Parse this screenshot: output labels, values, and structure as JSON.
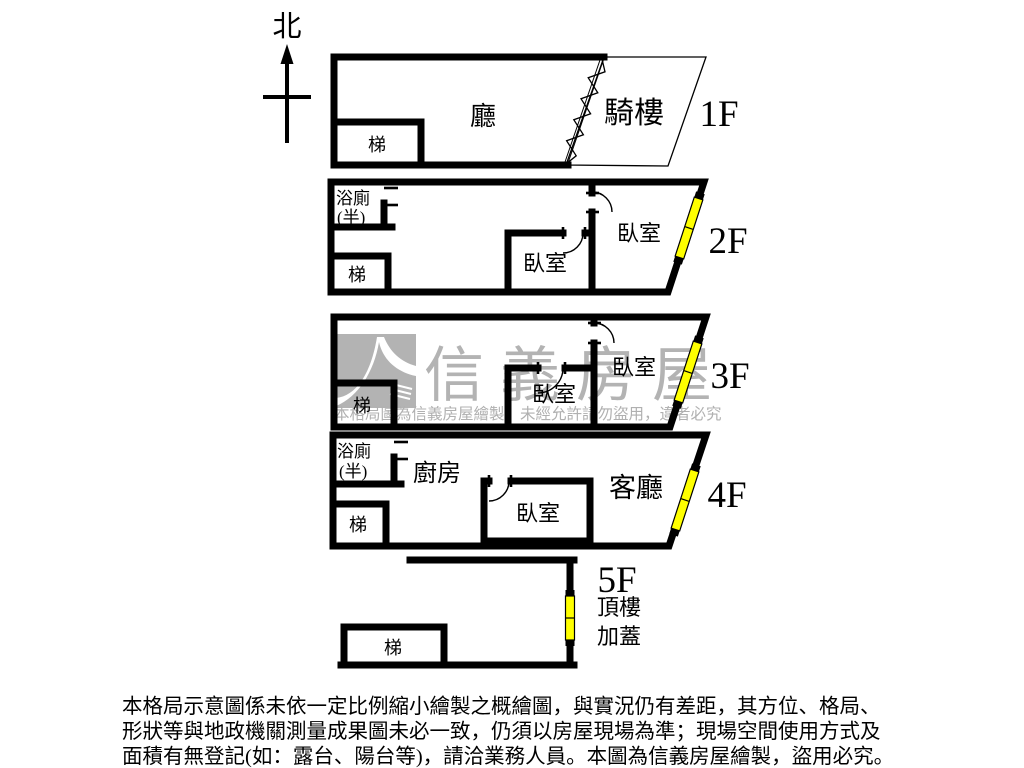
{
  "title": "房屋格局圖",
  "compass": {
    "north_label": "北"
  },
  "colors": {
    "wall": "#000000",
    "window_fill": "#ffff00",
    "watermark_gray": "#b3b3b3",
    "background": "#ffffff"
  },
  "floors": {
    "f1": {
      "label": "1F",
      "hall": "廳",
      "stairs": "梯",
      "arcade": "騎樓"
    },
    "f2": {
      "label": "2F",
      "bath_line1": "浴廁",
      "bath_line2": "(半)",
      "stairs": "梯",
      "bedroom_middle": "臥室",
      "bedroom_right": "臥室"
    },
    "f3": {
      "label": "3F",
      "stairs": "梯",
      "bedroom_middle": "臥室",
      "bedroom_right": "臥室"
    },
    "f4": {
      "label": "4F",
      "bath_line1": "浴廁",
      "bath_line2": "(半)",
      "kitchen": "廚房",
      "stairs": "梯",
      "bedroom": "臥室",
      "living_room": "客廳"
    },
    "f5": {
      "label": "5F",
      "stairs": "梯",
      "rooftop_line1": "頂樓",
      "rooftop_line2": "加蓋"
    }
  },
  "watermark": {
    "brand": "信義房屋",
    "notice": "本格局圖為信義房屋繪製，未經允許請勿盜用，違者必究"
  },
  "disclaimer": {
    "line1": "本格局示意圖係未依一定比例縮小繪製之概繪圖，與實況仍有差距，其方位、格局、",
    "line2": "形狀等與地政機關測量成果圖未必一致，仍須以房屋現場為準；現場空間使用方式及",
    "line3": "面積有無登記(如：露台、陽台等)，請洽業務人員。本圖為信義房屋繪製，盜用必究。"
  }
}
